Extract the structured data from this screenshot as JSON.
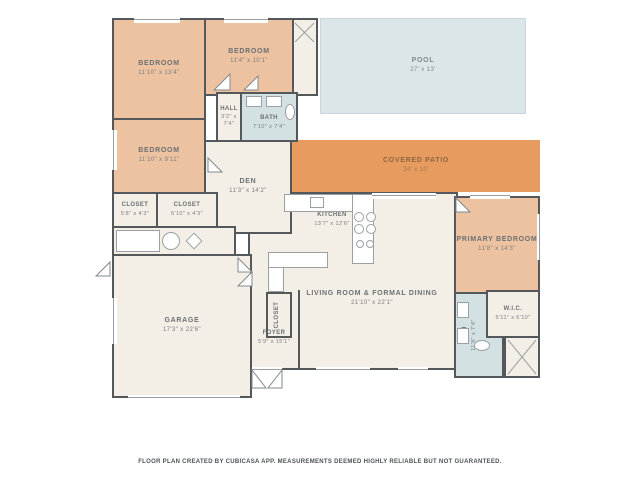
{
  "colors": {
    "wall": "#55585b",
    "floor": "#f3eee6",
    "bedroom": "#edc2a0",
    "patio": "#e89b5e",
    "pool": "#dbe6e8",
    "bath": "#d3e1e3",
    "label": "#6b7074",
    "patio_label": "#8a6742"
  },
  "icons": {
    "door-swing": "triangle",
    "window": "gap-with-line",
    "stove-burner": "circle",
    "sink": "rect",
    "toilet": "ellipse",
    "washer": "x-box",
    "water-heater": "circle"
  },
  "rooms": {
    "bedroom1": {
      "name": "BEDROOM",
      "dims": "11'10\" x 13'4\""
    },
    "bedroom2": {
      "name": "BEDROOM",
      "dims": "11'4\" x 10'1\""
    },
    "bedroom3": {
      "name": "BEDROOM",
      "dims": "11'10\" x 9'11\""
    },
    "hall": {
      "name": "HALL",
      "dims": "3'2\" x 7'4\""
    },
    "bath1": {
      "name": "BATH",
      "dims": "7'10\" x 7'4\""
    },
    "closet1": {
      "name": "CLOSET",
      "dims": "5'8\" x 4'3\""
    },
    "closet2": {
      "name": "CLOSET",
      "dims": "5'10\" x 4'3\""
    },
    "den": {
      "name": "DEN",
      "dims": "11'3\" x 14'2\""
    },
    "pool": {
      "name": "POOL",
      "dims": "27' x 13'"
    },
    "patio": {
      "name": "COVERED PATIO",
      "dims": "34' x 10'"
    },
    "kitchen": {
      "name": "KITCHEN",
      "dims": "13'7\" x 12'6\""
    },
    "living": {
      "name": "LIVING ROOM & FORMAL DINING",
      "dims": "21'10\" x 22'1\""
    },
    "primary": {
      "name": "PRIMARY BEDROOM",
      "dims": "11'8\" x 14'3\""
    },
    "wic": {
      "name": "W.I.C.",
      "dims": "5'11\" x 6'10\""
    },
    "bath2": {
      "name": "BATH",
      "dims": "11'8\" x 7'4\""
    },
    "garage": {
      "name": "GARAGE",
      "dims": "17'3\" x 22'6\""
    },
    "foyer": {
      "name": "FOYER",
      "dims": "5'9\" x 15'1\""
    },
    "foyerCloset": {
      "name": "CLOSET"
    }
  },
  "footer": {
    "disclaimer": "FLOOR PLAN CREATED BY CUBICASA APP. MEASUREMENTS DEEMED HIGHLY RELIABLE BUT NOT GUARANTEED."
  }
}
